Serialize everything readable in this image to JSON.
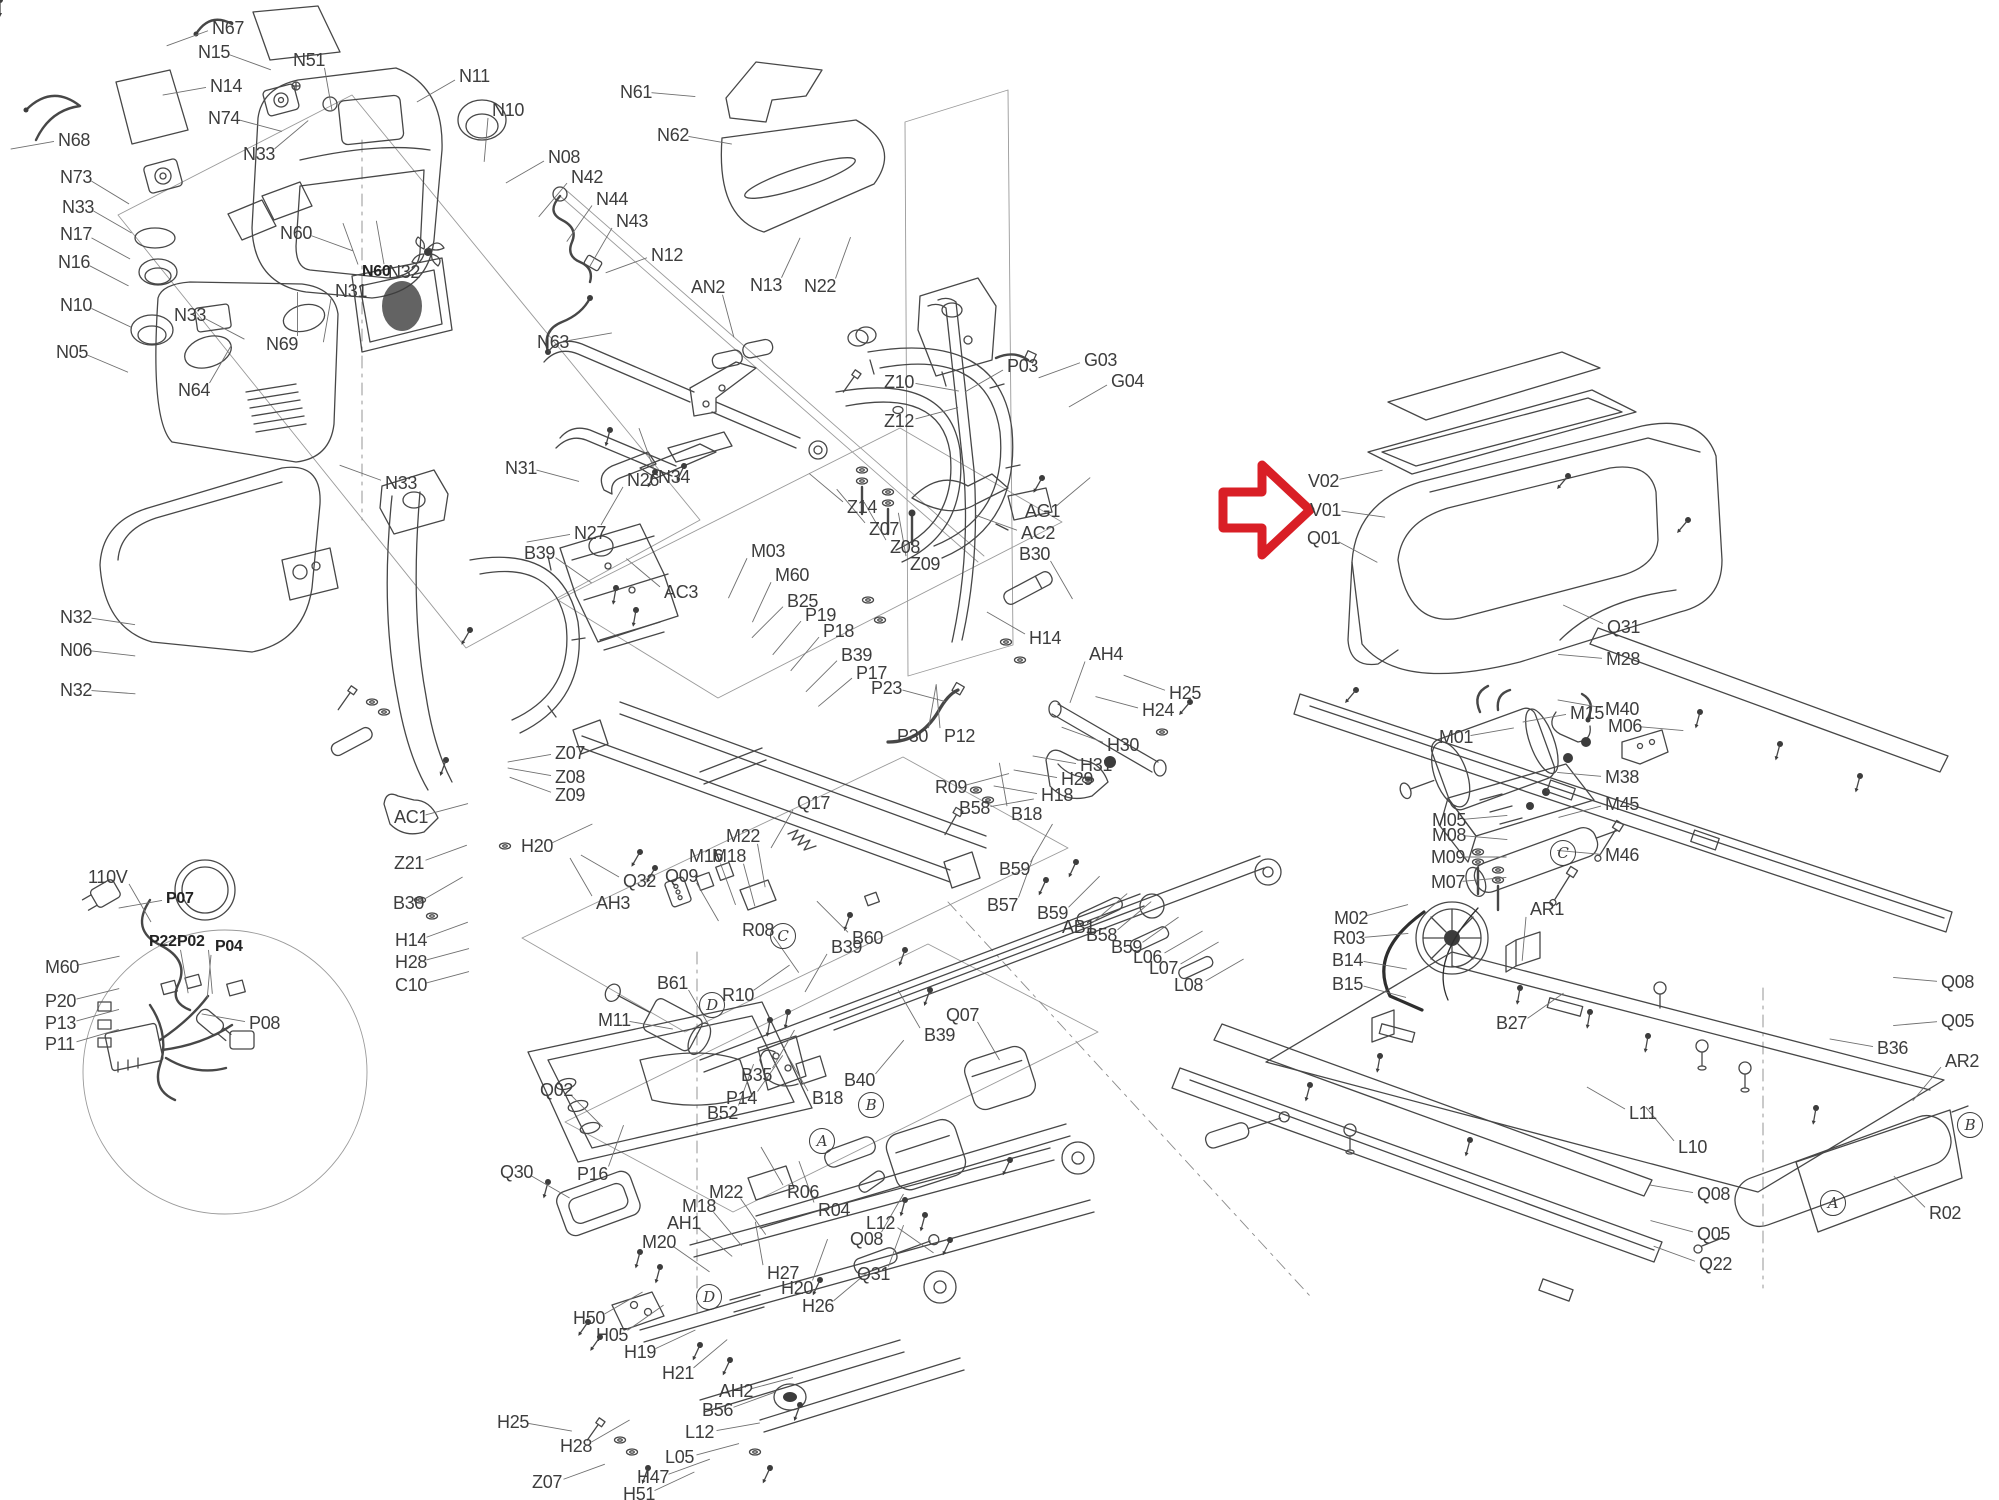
{
  "canvas": {
    "width": 1999,
    "height": 1500,
    "background": "#ffffff",
    "line_color": "#474747"
  },
  "arrow": {
    "points": "1223,492 1262,492 1262,465 1310,510 1262,555 1262,528 1223,528",
    "fill": "#ffffff",
    "stroke": "#d91f26",
    "stroke_width": 9
  },
  "labels": [
    {
      "t": "N67",
      "x": 212,
      "y": 28,
      "a": 160
    },
    {
      "t": "N15",
      "x": 198,
      "y": 52,
      "a": 20
    },
    {
      "t": "N51",
      "x": 293,
      "y": 60,
      "a": 80
    },
    {
      "t": "N14",
      "x": 210,
      "y": 86,
      "a": 170
    },
    {
      "t": "N74",
      "x": 208,
      "y": 118,
      "a": 15
    },
    {
      "t": "N33",
      "x": 243,
      "y": 154,
      "a": -40
    },
    {
      "t": "N68",
      "x": 58,
      "y": 140,
      "a": 170
    },
    {
      "t": "N73",
      "x": 60,
      "y": 177
    },
    {
      "t": "N33",
      "x": 62,
      "y": 207
    },
    {
      "t": "N17",
      "x": 60,
      "y": 234
    },
    {
      "t": "N16",
      "x": 58,
      "y": 262
    },
    {
      "t": "N10",
      "x": 60,
      "y": 305
    },
    {
      "t": "N05",
      "x": 56,
      "y": 352
    },
    {
      "t": "N60",
      "x": 280,
      "y": 233,
      "a": 20
    },
    {
      "t": "N33",
      "x": 174,
      "y": 315
    },
    {
      "t": "N69",
      "x": 266,
      "y": 344,
      "a": -90
    },
    {
      "t": "N64",
      "x": 178,
      "y": 390,
      "a": -60
    },
    {
      "t": "N31",
      "x": 335,
      "y": 291,
      "a": 100
    },
    {
      "t": "N60",
      "x": 362,
      "y": 272,
      "b": 1,
      "a": -110
    },
    {
      "t": "N32",
      "x": 388,
      "y": 272,
      "a": -100
    },
    {
      "t": "N33",
      "x": 385,
      "y": 483,
      "a": -160
    },
    {
      "t": "N32",
      "x": 60,
      "y": 617
    },
    {
      "t": "N06",
      "x": 60,
      "y": 650
    },
    {
      "t": "N32",
      "x": 60,
      "y": 690
    },
    {
      "t": "N11",
      "x": 459,
      "y": 76,
      "a": 150
    },
    {
      "t": "N10",
      "x": 492,
      "y": 110,
      "a": 95
    },
    {
      "t": "N08",
      "x": 548,
      "y": 157,
      "a": 150
    },
    {
      "t": "N42",
      "x": 571,
      "y": 177,
      "a": 130
    },
    {
      "t": "N44",
      "x": 596,
      "y": 199,
      "a": 125
    },
    {
      "t": "N43",
      "x": 616,
      "y": 221,
      "a": 120
    },
    {
      "t": "N12",
      "x": 651,
      "y": 255,
      "a": 160
    },
    {
      "t": "N61",
      "x": 620,
      "y": 92,
      "a": 5
    },
    {
      "t": "N62",
      "x": 657,
      "y": 135,
      "a": 10
    },
    {
      "t": "N13",
      "x": 750,
      "y": 285,
      "a": -65
    },
    {
      "t": "N22",
      "x": 804,
      "y": 286,
      "a": -70
    },
    {
      "t": "AN2",
      "x": 691,
      "y": 287,
      "a": 75
    },
    {
      "t": "N63",
      "x": 537,
      "y": 342,
      "a": -10
    },
    {
      "t": "N31",
      "x": 505,
      "y": 468,
      "a": 15
    },
    {
      "t": "N26",
      "x": 627,
      "y": 480,
      "a": 120
    },
    {
      "t": "N34",
      "x": 658,
      "y": 477,
      "a": -110
    },
    {
      "t": "N27",
      "x": 574,
      "y": 533,
      "a": 170
    },
    {
      "t": "M03",
      "x": 751,
      "y": 551,
      "a": 115
    },
    {
      "t": "M60",
      "x": 775,
      "y": 575,
      "a": 115
    },
    {
      "t": "AC3",
      "x": 664,
      "y": 592,
      "a": -140
    },
    {
      "t": "B25",
      "x": 787,
      "y": 601,
      "a": 135
    },
    {
      "t": "P19",
      "x": 805,
      "y": 615,
      "a": 130
    },
    {
      "t": "P18",
      "x": 823,
      "y": 631,
      "a": 130
    },
    {
      "t": "B39",
      "x": 841,
      "y": 655,
      "a": 135
    },
    {
      "t": "P17",
      "x": 856,
      "y": 673,
      "a": 140
    },
    {
      "t": "P23",
      "x": 871,
      "y": 688,
      "a": 15
    },
    {
      "t": "B39",
      "x": 524,
      "y": 553,
      "a": 35
    },
    {
      "t": "Z10",
      "x": 884,
      "y": 382,
      "a": 10
    },
    {
      "t": "Z12",
      "x": 884,
      "y": 421,
      "a": -15
    },
    {
      "t": "P03",
      "x": 1007,
      "y": 366,
      "a": 150
    },
    {
      "t": "G03",
      "x": 1084,
      "y": 360,
      "a": 160
    },
    {
      "t": "G04",
      "x": 1111,
      "y": 381,
      "a": 150
    },
    {
      "t": "Z14",
      "x": 847,
      "y": 507,
      "a": -140
    },
    {
      "t": "Z07",
      "x": 869,
      "y": 529,
      "a": -130
    },
    {
      "t": "Z08",
      "x": 890,
      "y": 547,
      "a": -120
    },
    {
      "t": "Z09",
      "x": 910,
      "y": 564,
      "a": -100
    },
    {
      "t": "AG1",
      "x": 1025,
      "y": 511,
      "a": -40
    },
    {
      "t": "AC2",
      "x": 1021,
      "y": 533,
      "a": -160
    },
    {
      "t": "B30",
      "x": 1019,
      "y": 554,
      "a": 60
    },
    {
      "t": "Z07",
      "x": 555,
      "y": 753,
      "a": 170
    },
    {
      "t": "Z08",
      "x": 555,
      "y": 777,
      "a": -170
    },
    {
      "t": "Z09",
      "x": 555,
      "y": 795,
      "a": -160
    },
    {
      "t": "AC1",
      "x": 394,
      "y": 817,
      "a": -15
    },
    {
      "t": "H20",
      "x": 521,
      "y": 846,
      "a": -25
    },
    {
      "t": "Z21",
      "x": 394,
      "y": 863,
      "a": -20
    },
    {
      "t": "B30",
      "x": 393,
      "y": 903,
      "a": -30
    },
    {
      "t": "H14",
      "x": 395,
      "y": 940,
      "a": -20
    },
    {
      "t": "H28",
      "x": 395,
      "y": 962,
      "a": -15
    },
    {
      "t": "C10",
      "x": 395,
      "y": 985,
      "a": -15
    },
    {
      "t": "Q32",
      "x": 623,
      "y": 881,
      "a": -150
    },
    {
      "t": "AH3",
      "x": 596,
      "y": 903,
      "a": -120
    },
    {
      "t": "Q09",
      "x": 665,
      "y": 876,
      "a": 60
    },
    {
      "t": "M16",
      "x": 689,
      "y": 856,
      "a": 70
    },
    {
      "t": "M18",
      "x": 712,
      "y": 856,
      "a": 75
    },
    {
      "t": "M22",
      "x": 726,
      "y": 836,
      "a": 80
    },
    {
      "t": "Q17",
      "x": 797,
      "y": 803,
      "a": 120
    },
    {
      "t": "H14",
      "x": 1029,
      "y": 638,
      "a": -150
    },
    {
      "t": "AH4",
      "x": 1089,
      "y": 654,
      "a": 110
    },
    {
      "t": "H25",
      "x": 1169,
      "y": 693,
      "a": -160
    },
    {
      "t": "H24",
      "x": 1142,
      "y": 710,
      "a": -165
    },
    {
      "t": "H30",
      "x": 1107,
      "y": 745,
      "a": -160
    },
    {
      "t": "H31",
      "x": 1080,
      "y": 765,
      "a": -170
    },
    {
      "t": "H29",
      "x": 1061,
      "y": 779,
      "a": -170
    },
    {
      "t": "H18",
      "x": 1041,
      "y": 795,
      "a": -170
    },
    {
      "t": "R09",
      "x": 935,
      "y": 787,
      "a": -15
    },
    {
      "t": "B58",
      "x": 959,
      "y": 808,
      "a": -10
    },
    {
      "t": "B18",
      "x": 1011,
      "y": 814,
      "a": -100
    },
    {
      "t": "B59",
      "x": 999,
      "y": 869,
      "a": -60
    },
    {
      "t": "B57",
      "x": 987,
      "y": 905,
      "a": -70
    },
    {
      "t": "B59",
      "x": 1037,
      "y": 913,
      "a": -45
    },
    {
      "t": "AB1",
      "x": 1062,
      "y": 927,
      "a": -40
    },
    {
      "t": "B58",
      "x": 1086,
      "y": 935,
      "a": -40
    },
    {
      "t": "B59",
      "x": 1111,
      "y": 947,
      "a": -35
    },
    {
      "t": "L06",
      "x": 1133,
      "y": 957,
      "a": -30
    },
    {
      "t": "L07",
      "x": 1149,
      "y": 968,
      "a": -30
    },
    {
      "t": "L08",
      "x": 1174,
      "y": 985,
      "a": -30
    },
    {
      "t": "P30",
      "x": 897,
      "y": 736,
      "a": -80
    },
    {
      "t": "P12",
      "x": 944,
      "y": 736,
      "a": -95
    },
    {
      "t": "V02",
      "x": 1308,
      "y": 481,
      "a": -12
    },
    {
      "t": "V01",
      "x": 1310,
      "y": 510,
      "a": 8
    },
    {
      "t": "Q01",
      "x": 1307,
      "y": 538,
      "a": 28
    },
    {
      "t": "Q31",
      "x": 1607,
      "y": 627,
      "a": -155
    },
    {
      "t": "M28",
      "x": 1606,
      "y": 659,
      "a": -175
    },
    {
      "t": "M15",
      "x": 1570,
      "y": 713,
      "a": 170
    },
    {
      "t": "M40",
      "x": 1605,
      "y": 709,
      "a": -170
    },
    {
      "t": "M06",
      "x": 1608,
      "y": 726,
      "a": 5
    },
    {
      "t": "M01",
      "x": 1439,
      "y": 737,
      "a": -10
    },
    {
      "t": "M38",
      "x": 1605,
      "y": 777,
      "a": -175
    },
    {
      "t": "M45",
      "x": 1605,
      "y": 804,
      "a": 165
    },
    {
      "t": "M05",
      "x": 1432,
      "y": 820,
      "a": -5
    },
    {
      "t": "M08",
      "x": 1432,
      "y": 835,
      "a": 5
    },
    {
      "t": "M09",
      "x": 1431,
      "y": 857,
      "a": 0
    },
    {
      "t": "M07",
      "x": 1431,
      "y": 882,
      "a": -5
    },
    {
      "t": "M46",
      "x": 1605,
      "y": 855,
      "a": -175
    },
    {
      "t": "AR1",
      "x": 1530,
      "y": 909,
      "a": 95
    },
    {
      "t": "M02",
      "x": 1334,
      "y": 918,
      "a": -15
    },
    {
      "t": "R03",
      "x": 1333,
      "y": 938,
      "a": -5
    },
    {
      "t": "B14",
      "x": 1332,
      "y": 960,
      "a": 10
    },
    {
      "t": "B15",
      "x": 1332,
      "y": 984,
      "a": 15
    },
    {
      "t": "B27",
      "x": 1496,
      "y": 1023,
      "a": -35
    },
    {
      "t": "L11",
      "x": 1629,
      "y": 1113,
      "a": -150
    },
    {
      "t": "L10",
      "x": 1678,
      "y": 1147,
      "a": -130
    },
    {
      "t": "Q08",
      "x": 1941,
      "y": 982,
      "a": -175
    },
    {
      "t": "Q05",
      "x": 1941,
      "y": 1021,
      "a": 175
    },
    {
      "t": "B36",
      "x": 1877,
      "y": 1048,
      "a": -170
    },
    {
      "t": "AR2",
      "x": 1945,
      "y": 1061,
      "a": 130
    },
    {
      "t": "Q08",
      "x": 1697,
      "y": 1194,
      "a": -170
    },
    {
      "t": "Q05",
      "x": 1697,
      "y": 1234,
      "a": -165
    },
    {
      "t": "Q22",
      "x": 1699,
      "y": 1264,
      "a": -160
    },
    {
      "t": "R02",
      "x": 1929,
      "y": 1213,
      "a": -135
    },
    {
      "t": "R08",
      "x": 742,
      "y": 930,
      "a": 55
    },
    {
      "t": "B60",
      "x": 852,
      "y": 938,
      "a": -135
    },
    {
      "t": "B39",
      "x": 831,
      "y": 947,
      "a": 120
    },
    {
      "t": "R10",
      "x": 722,
      "y": 995,
      "a": -35
    },
    {
      "t": "B61",
      "x": 657,
      "y": 983,
      "a": 60
    },
    {
      "t": "M11",
      "x": 598,
      "y": 1020,
      "a": 10
    },
    {
      "t": "B39",
      "x": 924,
      "y": 1035,
      "a": -120
    },
    {
      "t": "B35",
      "x": 741,
      "y": 1075,
      "a": -60
    },
    {
      "t": "P14",
      "x": 726,
      "y": 1098,
      "a": -55
    },
    {
      "t": "B52",
      "x": 707,
      "y": 1113,
      "a": -70
    },
    {
      "t": "B18",
      "x": 812,
      "y": 1098,
      "a": -120
    },
    {
      "t": "B40",
      "x": 844,
      "y": 1080,
      "a": -50
    },
    {
      "t": "Q02",
      "x": 540,
      "y": 1090,
      "a": 45
    },
    {
      "t": "Q30",
      "x": 500,
      "y": 1172,
      "a": 30
    },
    {
      "t": "P16",
      "x": 577,
      "y": 1174,
      "a": -70
    },
    {
      "t": "M22",
      "x": 709,
      "y": 1192,
      "a": 55
    },
    {
      "t": "M18",
      "x": 682,
      "y": 1206,
      "a": 50
    },
    {
      "t": "AH1",
      "x": 667,
      "y": 1223,
      "a": 40
    },
    {
      "t": "M20",
      "x": 642,
      "y": 1242,
      "a": 35
    },
    {
      "t": "H27",
      "x": 767,
      "y": 1273,
      "a": -100
    },
    {
      "t": "H20",
      "x": 781,
      "y": 1288,
      "a": -70
    },
    {
      "t": "H26",
      "x": 802,
      "y": 1306,
      "a": -40
    },
    {
      "t": "L12",
      "x": 866,
      "y": 1223,
      "a": 35
    },
    {
      "t": "H50",
      "x": 573,
      "y": 1318,
      "a": -30
    },
    {
      "t": "H05",
      "x": 596,
      "y": 1335,
      "a": -35
    },
    {
      "t": "H19",
      "x": 624,
      "y": 1352,
      "a": -25
    },
    {
      "t": "H21",
      "x": 662,
      "y": 1373,
      "a": -40
    },
    {
      "t": "R06",
      "x": 787,
      "y": 1192,
      "a": -120
    },
    {
      "t": "R04",
      "x": 818,
      "y": 1210,
      "a": -110
    },
    {
      "t": "Q08",
      "x": 850,
      "y": 1239,
      "a": -60
    },
    {
      "t": "Q31",
      "x": 857,
      "y": 1274,
      "a": -70
    },
    {
      "t": "Q07",
      "x": 946,
      "y": 1015,
      "a": 60
    },
    {
      "t": "H25",
      "x": 497,
      "y": 1422,
      "a": 10
    },
    {
      "t": "H28",
      "x": 560,
      "y": 1446,
      "a": -30
    },
    {
      "t": "Z07",
      "x": 532,
      "y": 1482,
      "a": -20
    },
    {
      "t": "B56",
      "x": 702,
      "y": 1410,
      "a": -20
    },
    {
      "t": "AH2",
      "x": 719,
      "y": 1391,
      "a": -15
    },
    {
      "t": "L12",
      "x": 685,
      "y": 1432,
      "a": -10
    },
    {
      "t": "L05",
      "x": 665,
      "y": 1457,
      "a": -15
    },
    {
      "t": "H47",
      "x": 637,
      "y": 1477,
      "a": -20
    },
    {
      "t": "H51",
      "x": 623,
      "y": 1494,
      "a": -25
    },
    {
      "t": "110V",
      "x": 88,
      "y": 877,
      "a": 60
    },
    {
      "t": "P07",
      "x": 166,
      "y": 899,
      "b": 1,
      "a": 170
    },
    {
      "t": "P22",
      "x": 149,
      "y": 942,
      "b": 1,
      "a": 80
    },
    {
      "t": "P02",
      "x": 177,
      "y": 942,
      "b": 1,
      "a": 85
    },
    {
      "t": "P04",
      "x": 215,
      "y": 947,
      "b": 1,
      "a": 95
    },
    {
      "t": "M60",
      "x": 45,
      "y": 967
    },
    {
      "t": "P20",
      "x": 45,
      "y": 1001
    },
    {
      "t": "P13",
      "x": 45,
      "y": 1023
    },
    {
      "t": "P11",
      "x": 45,
      "y": 1044
    },
    {
      "t": "P08",
      "x": 249,
      "y": 1023,
      "a": -170
    },
    {
      "t": "A",
      "x": 822,
      "y": 1141,
      "c": 1
    },
    {
      "t": "B",
      "x": 871,
      "y": 1105,
      "c": 1
    },
    {
      "t": "C",
      "x": 783,
      "y": 936,
      "c": 1
    },
    {
      "t": "D",
      "x": 712,
      "y": 1005,
      "c": 1
    },
    {
      "t": "D",
      "x": 709,
      "y": 1297,
      "c": 1
    },
    {
      "t": "C",
      "x": 1563,
      "y": 853,
      "c": 1
    },
    {
      "t": "A",
      "x": 1833,
      "y": 1203,
      "c": 1
    },
    {
      "t": "B",
      "x": 1970,
      "y": 1125,
      "c": 1
    }
  ]
}
